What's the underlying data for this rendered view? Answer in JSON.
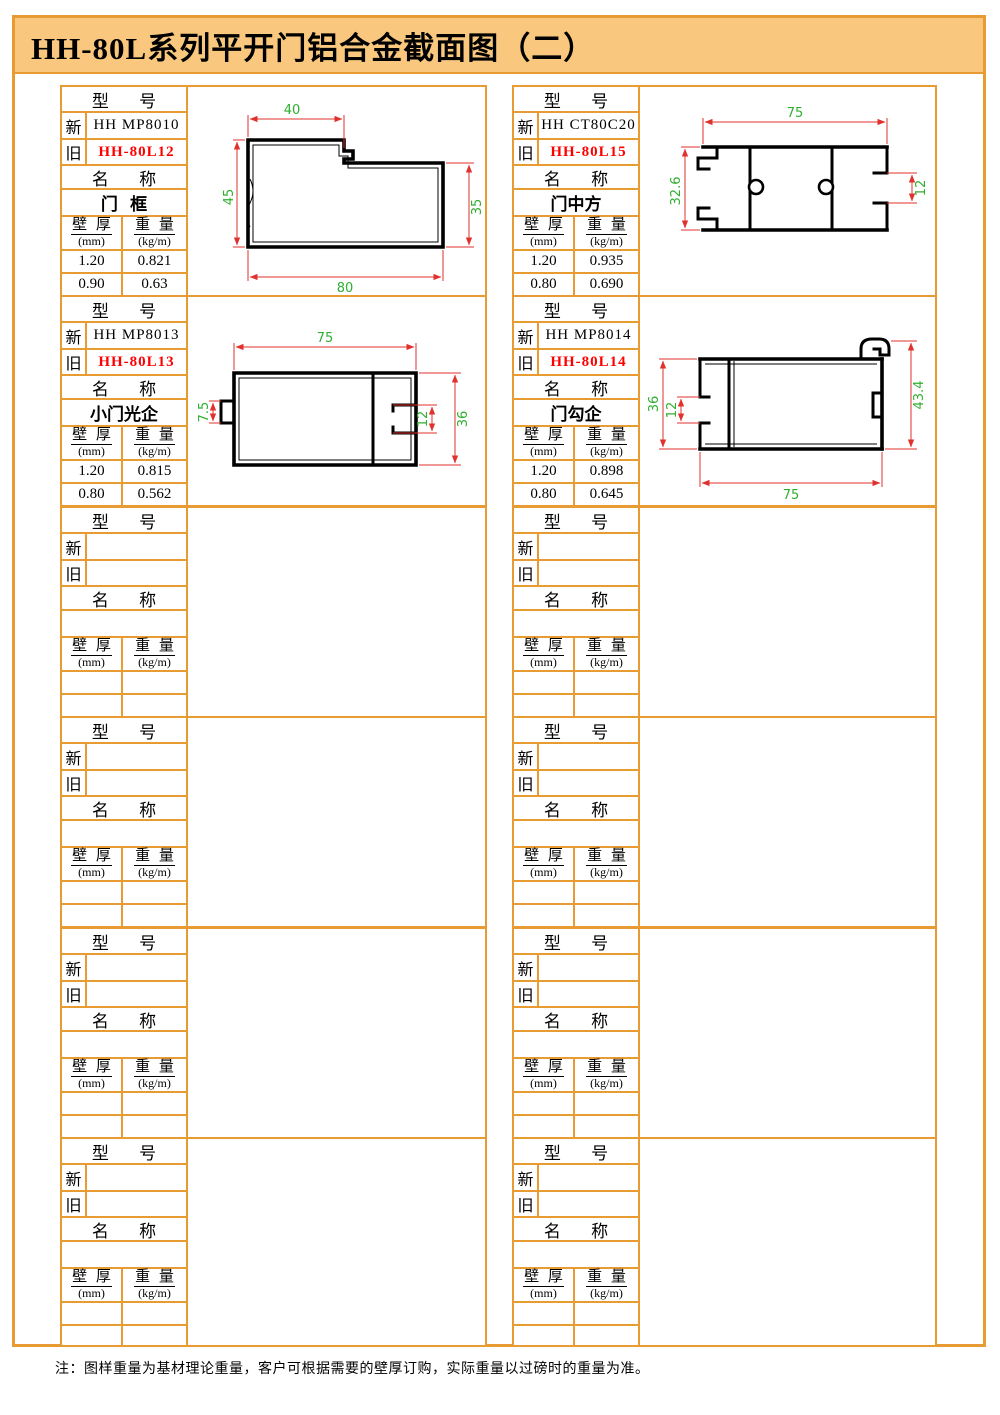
{
  "title": "HH-80L系列平开门铝合金截面图（二）",
  "note": "注：图样重量为基材理论重量，客户可根据需要的壁厚订购，实际重量以过磅时的重量为准。",
  "labels": {
    "model_label": "型 号",
    "new_label": "新",
    "old_label": "旧",
    "name_label": "名 称",
    "thickness_label": "壁 厚",
    "thickness_unit": "(mm)",
    "weight_label": "重 量",
    "weight_unit": "(kg/m)"
  },
  "colors": {
    "border_orange": "#E89B33",
    "title_background": "#F9C87E",
    "old_model_red": "#FF0000",
    "dimension_line_red": "#E0312D",
    "dimension_text_green": "#2FAF2F"
  },
  "blocks": [
    {
      "new_model": "HH MP8010",
      "old_model": "HH-80L12",
      "name": "门 框",
      "rows": [
        {
          "thickness": "1.20",
          "weight": "0.821"
        },
        {
          "thickness": "0.90",
          "weight": "0.63"
        }
      ],
      "dims": {
        "top": "40",
        "left": "45",
        "right": "35",
        "bottom": "80"
      }
    },
    {
      "new_model": "HH CT80C20",
      "old_model": "HH-80L15",
      "name": "门中方",
      "rows": [
        {
          "thickness": "1.20",
          "weight": "0.935"
        },
        {
          "thickness": "0.80",
          "weight": "0.690"
        }
      ],
      "dims": {
        "top": "75",
        "left": "32.6",
        "right": "12"
      }
    },
    {
      "new_model": "HH MP8013",
      "old_model": "HH-80L13",
      "name": "小门光企",
      "rows": [
        {
          "thickness": "1.20",
          "weight": "0.815"
        },
        {
          "thickness": "0.80",
          "weight": "0.562"
        }
      ],
      "dims": {
        "top": "75",
        "left": "7.5",
        "inner": "12",
        "right": "36"
      }
    },
    {
      "new_model": "HH MP8014",
      "old_model": "HH-80L14",
      "name": "门勾企",
      "rows": [
        {
          "thickness": "1.20",
          "weight": "0.898"
        },
        {
          "thickness": "0.80",
          "weight": "0.645"
        }
      ],
      "dims": {
        "left": "36",
        "inner": "12",
        "right": "43.4",
        "bottom": "75"
      }
    },
    {
      "new_model": "",
      "old_model": "",
      "name": "",
      "rows": [
        {
          "thickness": "",
          "weight": ""
        },
        {
          "thickness": "",
          "weight": ""
        }
      ]
    },
    {
      "new_model": "",
      "old_model": "",
      "name": "",
      "rows": [
        {
          "thickness": "",
          "weight": ""
        },
        {
          "thickness": "",
          "weight": ""
        }
      ]
    },
    {
      "new_model": "",
      "old_model": "",
      "name": "",
      "rows": [
        {
          "thickness": "",
          "weight": ""
        },
        {
          "thickness": "",
          "weight": ""
        }
      ]
    },
    {
      "new_model": "",
      "old_model": "",
      "name": "",
      "rows": [
        {
          "thickness": "",
          "weight": ""
        },
        {
          "thickness": "",
          "weight": ""
        }
      ]
    },
    {
      "new_model": "",
      "old_model": "",
      "name": "",
      "rows": [
        {
          "thickness": "",
          "weight": ""
        },
        {
          "thickness": "",
          "weight": ""
        }
      ]
    },
    {
      "new_model": "",
      "old_model": "",
      "name": "",
      "rows": [
        {
          "thickness": "",
          "weight": ""
        },
        {
          "thickness": "",
          "weight": ""
        }
      ]
    },
    {
      "new_model": "",
      "old_model": "",
      "name": "",
      "rows": [
        {
          "thickness": "",
          "weight": ""
        },
        {
          "thickness": "",
          "weight": ""
        }
      ]
    },
    {
      "new_model": "",
      "old_model": "",
      "name": "",
      "rows": [
        {
          "thickness": "",
          "weight": ""
        },
        {
          "thickness": "",
          "weight": ""
        }
      ]
    }
  ]
}
